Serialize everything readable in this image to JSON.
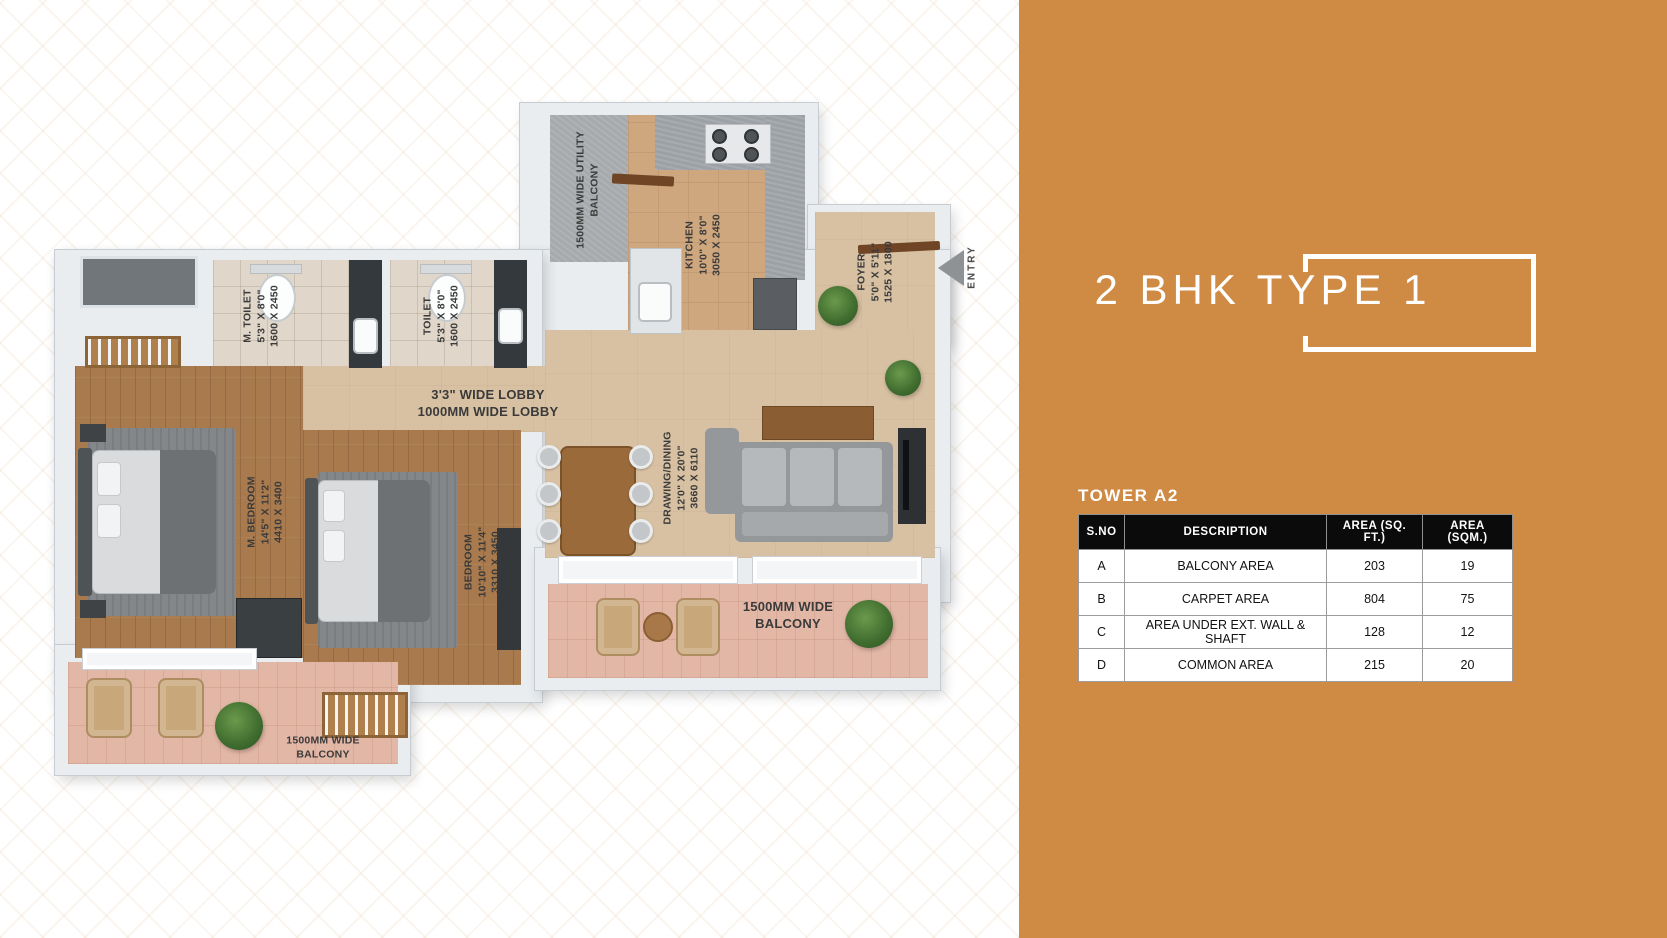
{
  "panel": {
    "title": "2 BHK TYPE 1",
    "table_title": "TOWER A2",
    "table": {
      "headers": [
        "S.NO",
        "DESCRIPTION",
        "AREA (SQ. FT.)",
        "AREA (SQM.)"
      ],
      "rows": [
        [
          "A",
          "BALCONY AREA",
          "203",
          "19"
        ],
        [
          "B",
          "CARPET AREA",
          "804",
          "75"
        ],
        [
          "C",
          "AREA UNDER EXT. WALL & SHAFT",
          "128",
          "12"
        ],
        [
          "D",
          "COMMON AREA",
          "215",
          "20"
        ]
      ]
    },
    "accent_color": "#CF8A43",
    "table_header_bg": "#0B0B0B"
  },
  "floorplan": {
    "labels": {
      "utility_balcony": "1500MM WIDE UTILITY\nBALCONY",
      "kitchen": "KITCHEN\n10'0\" X 8'0\"\n3050 X 2450",
      "m_toilet": "M. TOILET\n5'3\" X 8'0\"\n1600 X 2450",
      "toilet": "TOILET\n5'3\" X 8'0\"\n1600 X 2450",
      "foyer": "FOYER\n5'0\" X 5'11\"\n1525 X 1800",
      "entry": "ENTRY",
      "lobby": "3'3\" WIDE LOBBY\n1000MM WIDE LOBBY",
      "m_bedroom": "M. BEDROOM\n14'5\" X 11'2\"\n4410 X 3400",
      "bedroom": "BEDROOM\n10'10\" X 11'4\"\n3310 X 3450",
      "drawing_dining": "DRAWING/DINING\n12'0\" X 20'0\"\n3660 X 6110",
      "balcony_right": "1500MM WIDE\nBALCONY",
      "balcony_left": "1500MM WIDE\nBALCONY"
    }
  }
}
